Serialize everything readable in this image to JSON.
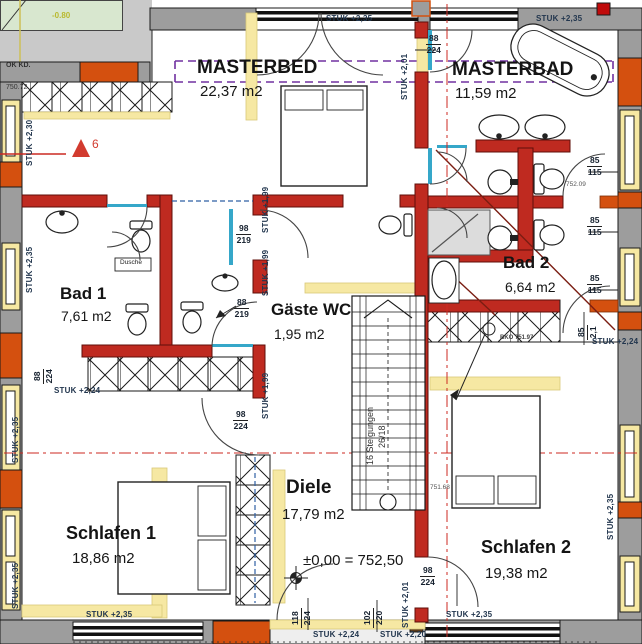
{
  "colors": {
    "wall_red": "#bf2a20",
    "wall_gray": "#9d9d9d",
    "accent_orange": "#d4500f",
    "light_wall_yellow": "#f6e8a3",
    "terrain_green": "#d8e7cf",
    "axis_red": "#cc2a22",
    "roof_purple": "#7030a0",
    "dim_text_blue": "#22364e",
    "lintel_blue": "#2e5fa3",
    "glass_cyan": "#35a7c9"
  },
  "rooms": [
    {
      "name": "MASTERBED",
      "area": "22,37 m2"
    },
    {
      "name": "MASTERBAD",
      "area": "11,59 m2"
    },
    {
      "name": "Bad 1",
      "area": "7,61 m2"
    },
    {
      "name": "Bad 2",
      "area": "6,64 m2"
    },
    {
      "name": "Gäste WC",
      "area": "1,95 m2"
    },
    {
      "name": "Diele",
      "area": "17,79 m2"
    },
    {
      "name": "Schlafen 1",
      "area": "18,86 m2"
    },
    {
      "name": "Schlafen 2",
      "area": "19,38 m2"
    }
  ],
  "labels": [
    {
      "name": "ok-kd-label",
      "text": "OK KD.",
      "x": 6,
      "y": 62,
      "size": 7,
      "weight": 700,
      "color": "#333"
    },
    {
      "name": "level-top-left",
      "text": "750.72",
      "x": 6,
      "y": 84,
      "size": 7,
      "color": "#333"
    },
    {
      "name": "level-minus-080",
      "text": "-0.80",
      "x": 52,
      "y": 12,
      "size": 8,
      "weight": 700,
      "color": "#b9b92f"
    },
    {
      "name": "axis-number",
      "text": "6",
      "x": 92,
      "y": 138,
      "size": 12,
      "color": "#d23b2f"
    },
    {
      "name": "room-label-masterbed",
      "text": "MASTERBED",
      "x": 197,
      "y": 58,
      "size": 19,
      "weight": 700,
      "cls": "room"
    },
    {
      "name": "area-label-masterbed",
      "text": "22,37 m2",
      "x": 200,
      "y": 84,
      "size": 15
    },
    {
      "name": "room-label-masterbad",
      "text": "MASTERBAD",
      "x": 452,
      "y": 60,
      "size": 19,
      "weight": 700,
      "cls": "room"
    },
    {
      "name": "area-label-masterbad",
      "text": "11,59 m2",
      "x": 455,
      "y": 86,
      "size": 15
    },
    {
      "name": "stuk-top-center",
      "text": "STUK +2,35",
      "x": 326,
      "y": 15,
      "size": 8,
      "cls": "dim"
    },
    {
      "name": "stuk-top-right",
      "text": "STUK +2,35",
      "x": 536,
      "y": 15,
      "size": 8,
      "cls": "dim"
    },
    {
      "name": "dim-door-masterbad",
      "type": "fraction",
      "top": "88",
      "bottom": "224",
      "x": 426,
      "y": 34
    },
    {
      "name": "stuk-spine-top",
      "text": "STUK +2,01",
      "x": 401,
      "y": 100,
      "rot": -90,
      "size": 8,
      "cls": "dim"
    },
    {
      "name": "stuk-left-upper",
      "text": "STUK +2,30",
      "x": 26,
      "y": 166,
      "rot": -90,
      "size": 8,
      "cls": "dim"
    },
    {
      "name": "stuk-left-mid",
      "text": "STUK +2,35",
      "x": 26,
      "y": 293,
      "rot": -90,
      "size": 8,
      "cls": "dim"
    },
    {
      "name": "room-label-bad1",
      "text": "Bad 1",
      "x": 60,
      "y": 285,
      "size": 17,
      "weight": 700,
      "cls": "room"
    },
    {
      "name": "area-label-bad1",
      "text": "7,61 m2",
      "x": 61,
      "y": 309,
      "size": 14
    },
    {
      "name": "dim-left-88-224",
      "type": "fraction",
      "top": "88",
      "bottom": "224",
      "x": 33,
      "y": 384,
      "rot": -90
    },
    {
      "name": "stuk-bad1-bottom",
      "text": "STUK +2,24",
      "x": 54,
      "y": 387,
      "size": 8,
      "cls": "dim"
    },
    {
      "name": "dim-wc-98-219",
      "type": "fraction",
      "top": "98",
      "bottom": "219",
      "x": 236,
      "y": 224
    },
    {
      "name": "dim-wc-88-219",
      "type": "fraction",
      "top": "88",
      "bottom": "219",
      "x": 234,
      "y": 298
    },
    {
      "name": "stuk-gwc-a",
      "text": "STUK +1,99",
      "x": 262,
      "y": 233,
      "rot": -90,
      "size": 8,
      "cls": "dim"
    },
    {
      "name": "stuk-gwc-b",
      "text": "STUK +1,99",
      "x": 262,
      "y": 296,
      "rot": -90,
      "size": 8,
      "cls": "dim"
    },
    {
      "name": "stuk-gwc-c",
      "text": "STUK +1,99",
      "x": 262,
      "y": 419,
      "rot": -90,
      "size": 8,
      "cls": "dim"
    },
    {
      "name": "room-label-gaeste-wc",
      "text": "Gäste WC",
      "x": 271,
      "y": 301,
      "size": 17,
      "weight": 700,
      "cls": "room"
    },
    {
      "name": "area-label-gaeste-wc",
      "text": "1,95 m2",
      "x": 274,
      "y": 327,
      "size": 14
    },
    {
      "name": "stairs-note-line1",
      "text": "16 Steigungen",
      "x": 366,
      "y": 465,
      "rot": -90,
      "size": 9,
      "color": "#333"
    },
    {
      "name": "stairs-note-line2",
      "text": "26/18",
      "x": 378,
      "y": 448,
      "rot": -90,
      "size": 9,
      "color": "#333"
    },
    {
      "name": "room-label-bad2",
      "text": "Bad 2",
      "x": 503,
      "y": 254,
      "size": 17,
      "weight": 700,
      "cls": "room"
    },
    {
      "name": "area-label-bad2",
      "text": "6,64 m2",
      "x": 505,
      "y": 280,
      "size": 14
    },
    {
      "name": "dim-right-a",
      "type": "fraction",
      "top": "85",
      "bottom": "115",
      "x": 587,
      "y": 156
    },
    {
      "name": "level-752-09",
      "text": "752.09",
      "x": 566,
      "y": 182,
      "size": 6.5,
      "color": "#555"
    },
    {
      "name": "dim-right-b",
      "type": "fraction",
      "top": "85",
      "bottom": "115",
      "x": 587,
      "y": 216
    },
    {
      "name": "dim-right-c",
      "type": "fraction",
      "top": "85",
      "bottom": "115",
      "x": 587,
      "y": 274
    },
    {
      "name": "dim-door-85",
      "type": "fraction",
      "top": "85",
      "bottom": "2,1",
      "x": 577,
      "y": 340,
      "rot": -90
    },
    {
      "name": "stuk-right-224",
      "text": "STUK +2,24",
      "x": 592,
      "y": 338,
      "size": 8,
      "cls": "dim"
    },
    {
      "name": "bko-level",
      "text": "BKO 751.97",
      "x": 500,
      "y": 335,
      "size": 6,
      "weight": 700,
      "color": "#444"
    },
    {
      "name": "level-751-68",
      "text": "751.68",
      "x": 430,
      "y": 485,
      "size": 6.5,
      "color": "#555"
    },
    {
      "name": "room-label-diele",
      "text": "Diele",
      "x": 286,
      "y": 478,
      "size": 19,
      "weight": 700,
      "cls": "room"
    },
    {
      "name": "area-label-diele",
      "text": "17,79 m2",
      "x": 282,
      "y": 507,
      "size": 15
    },
    {
      "name": "level-zero",
      "text": "±0,00 = 752,50",
      "x": 303,
      "y": 553,
      "size": 15
    },
    {
      "name": "room-label-schlafen1",
      "text": "Schlafen 1",
      "x": 66,
      "y": 524,
      "size": 18,
      "weight": 700,
      "cls": "room"
    },
    {
      "name": "area-label-schlafen1",
      "text": "18,86 m2",
      "x": 72,
      "y": 551,
      "size": 15
    },
    {
      "name": "room-label-schlafen2",
      "text": "Schlafen 2",
      "x": 481,
      "y": 538,
      "size": 18,
      "weight": 700,
      "cls": "room"
    },
    {
      "name": "area-label-schlafen2",
      "text": "19,38 m2",
      "x": 485,
      "y": 566,
      "size": 15
    },
    {
      "name": "dim-diele-98-224",
      "type": "fraction",
      "top": "98",
      "bottom": "224",
      "x": 233,
      "y": 410
    },
    {
      "name": "dim-s2-98-224",
      "type": "fraction",
      "top": "98",
      "bottom": "224",
      "x": 420,
      "y": 566
    },
    {
      "name": "stuk-s2-bottom",
      "text": "STUK +2,01",
      "x": 402,
      "y": 628,
      "rot": -90,
      "size": 8,
      "cls": "dim"
    },
    {
      "name": "dim-102-220",
      "type": "fraction",
      "top": "102",
      "bottom": "220",
      "x": 363,
      "y": 628,
      "rot": -90
    },
    {
      "name": "dim-118-224",
      "type": "fraction",
      "top": "118",
      "bottom": "224",
      "x": 291,
      "y": 628,
      "rot": -90
    },
    {
      "name": "stuk-bottom-left",
      "text": "STUK +2,35",
      "x": 86,
      "y": 611,
      "size": 8,
      "cls": "dim"
    },
    {
      "name": "stuk-bottom-center",
      "text": "STUK +2,35",
      "x": 446,
      "y": 611,
      "size": 8,
      "cls": "dim"
    },
    {
      "name": "stuk-bottom-224",
      "text": "STUK +2,24",
      "x": 313,
      "y": 631,
      "size": 8,
      "cls": "dim"
    },
    {
      "name": "stuk-bottom-220",
      "text": "STUK +2,20",
      "x": 380,
      "y": 631,
      "size": 8,
      "cls": "dim"
    },
    {
      "name": "stuk-right-schlafen2",
      "text": "STUK +2,35",
      "x": 607,
      "y": 540,
      "rot": -90,
      "size": 8,
      "cls": "dim"
    },
    {
      "name": "stuk-left-low-a",
      "text": "STUK +2,35",
      "x": 12,
      "y": 463,
      "rot": -90,
      "size": 8,
      "cls": "dim"
    },
    {
      "name": "stuk-left-low-b",
      "text": "STUK +2,35",
      "x": 12,
      "y": 609,
      "rot": -90,
      "size": 8,
      "cls": "dim"
    },
    {
      "name": "dusche-label",
      "text": "Dusche",
      "x": 120,
      "y": 260,
      "size": 6.5,
      "color": "#222"
    }
  ]
}
